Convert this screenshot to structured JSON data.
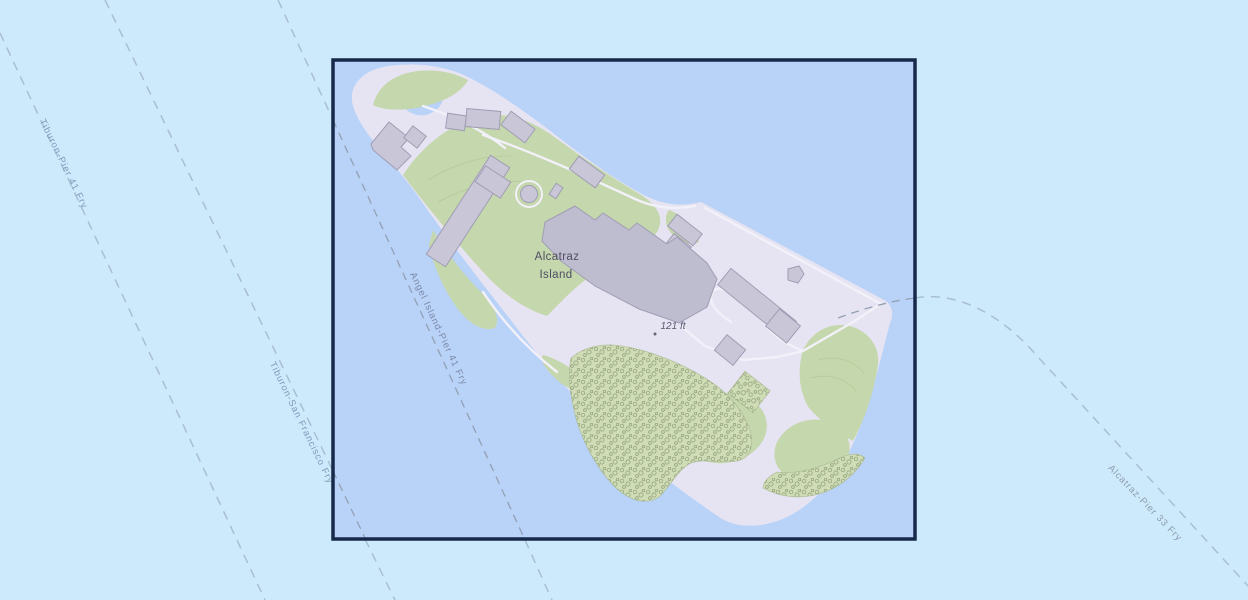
{
  "map": {
    "name": "Alcatraz Island map with selection extent",
    "labels": {
      "island_line1": "Alcatraz",
      "island_line2": "Island",
      "elevation": "121 ft"
    },
    "routes": {
      "tiburon_pier41": "Tiburon-Pier 41 Fry",
      "tiburon_sf": "Tiburon-San Francisco Fry",
      "angel_island_pier41": "Angel Island-Pier 41 Fry",
      "alcatraz_pier33": "Alcatraz-Pier 33 Fry"
    },
    "colors": {
      "water_outside": "#cdeafc",
      "water_inside": "#b9d2f8",
      "selection_border": "#16294b",
      "island_ground": "#e6e4f2",
      "vegetation": "#c5d7ac",
      "scrub": "#cfdcb6",
      "building_fill": "#c9c7d7",
      "cellhouse_fill": "#bebccf",
      "route_line_outside": "#a9bed3",
      "route_line_inside": "#93a0b4",
      "route_label": "#7e9bba"
    }
  }
}
